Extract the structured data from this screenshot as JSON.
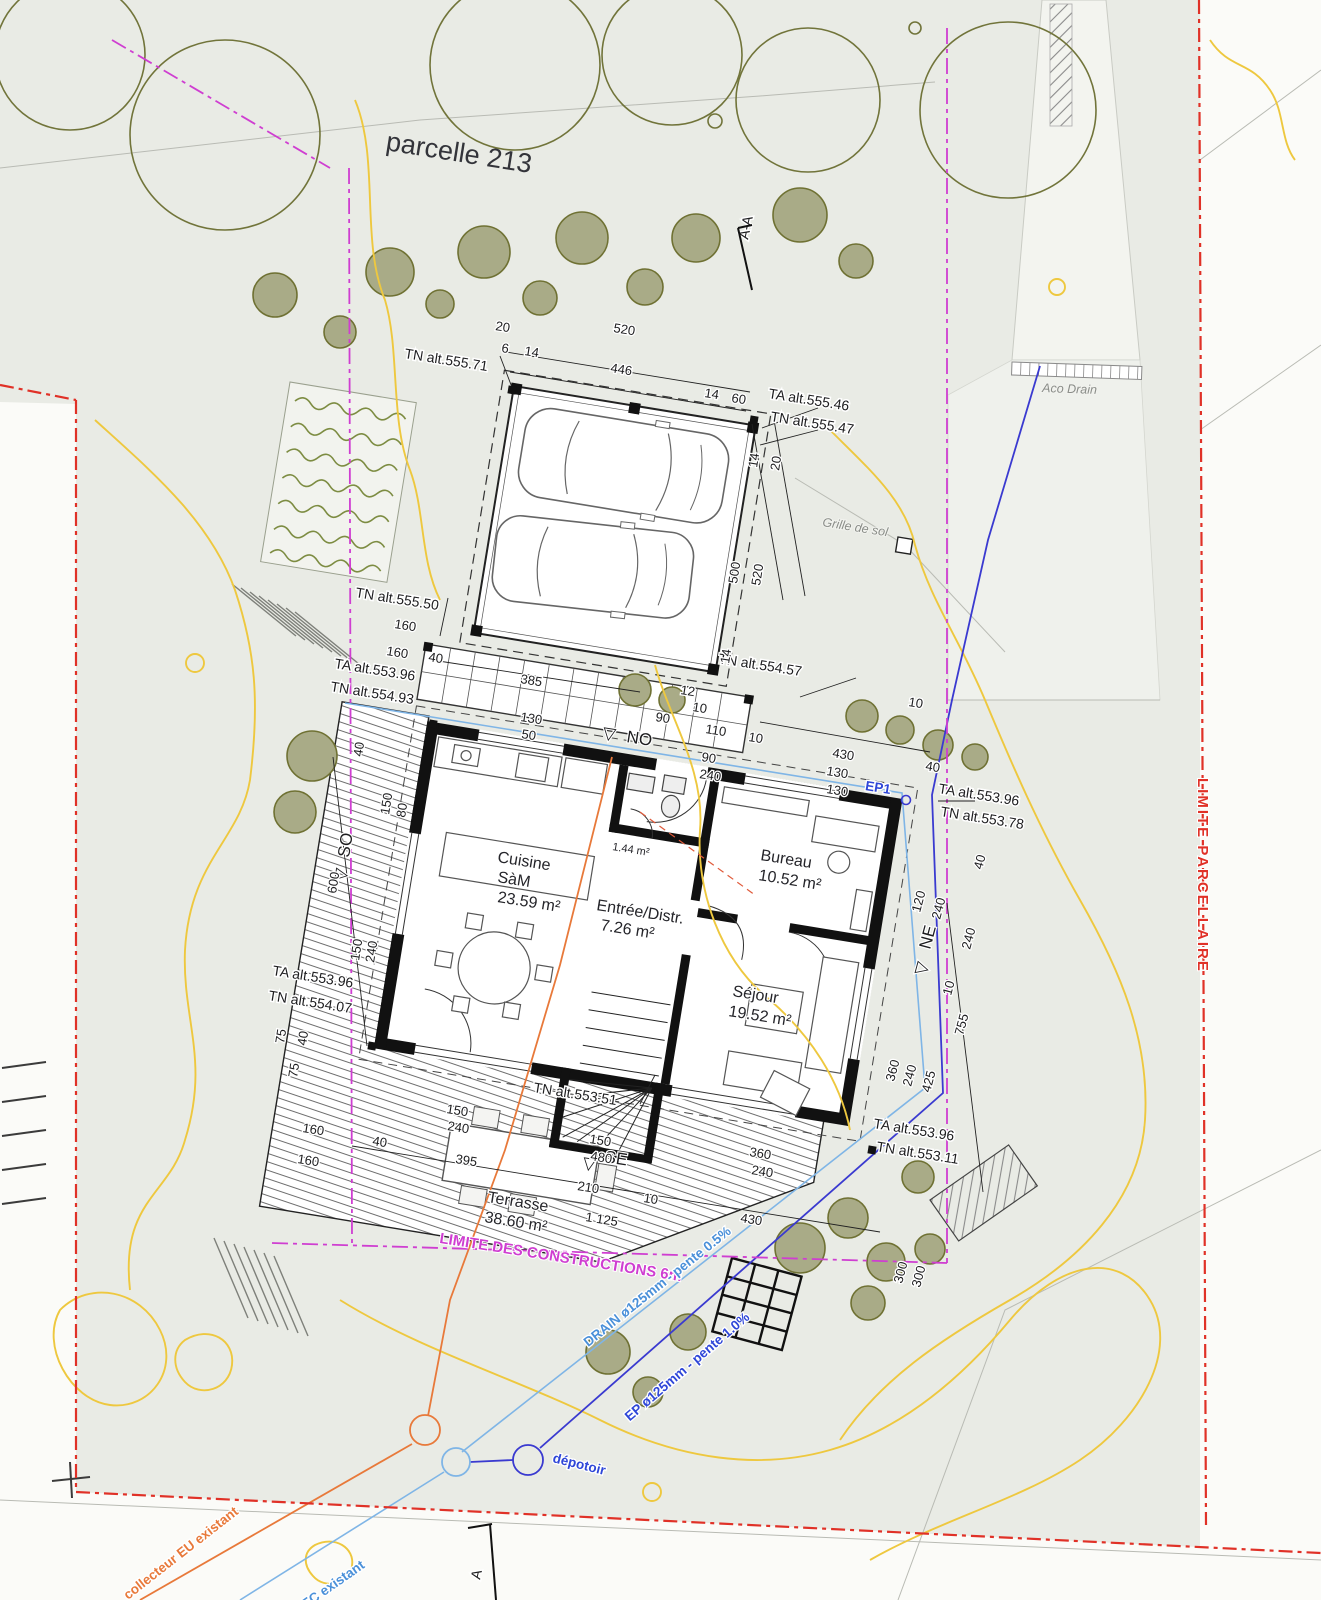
{
  "title": "parcelle 213",
  "limits": {
    "constructions": "LIMITE DES CONSTRUCTIONS 6m",
    "parcellaire": "LIMITE PARCELLAIRE"
  },
  "levels": {
    "tn_555_71": "TN alt.555.71",
    "ta_555_46": "TA alt.555.46",
    "tn_555_47": "TN alt.555.47",
    "tn_555_50": "TN alt.555.50",
    "ta_553_96_a": "TA alt.553.96",
    "tn_554_93": "TN alt.554.93",
    "tn_554_57": "TN alt.554.57",
    "ta_553_96_b": "TA alt.553.96",
    "tn_553_78": "TN alt.553.78",
    "ta_553_96_c": "TA alt.553.96",
    "tn_554_07": "TN alt.554.07",
    "tn_553_51": "TN alt.553.51",
    "ta_553_96_d": "TA alt.553.96",
    "tn_553_11": "TN alt.553.11"
  },
  "rooms": {
    "cuisine": {
      "name": "Cuisine",
      "name2": "SàM",
      "area": "23.59 m²"
    },
    "wc": {
      "area": "1.44 m²"
    },
    "entree": {
      "name": "Entrée/Distr.",
      "area": "7.26 m²"
    },
    "bureau": {
      "name": "Bureau",
      "area": "10.52 m²"
    },
    "sejour": {
      "name": "Séjour",
      "area": "19.52 m²"
    },
    "terrasse": {
      "name": "Terrasse",
      "area": "38.60 m²"
    }
  },
  "pipes": {
    "drain": "DRAIN ø125mm - pente 0.5%",
    "ep": "EP ø125mm - pente 1.0%",
    "ep1": "EP1",
    "depotoir": "dépotoir",
    "eu": "collecteur EU existant",
    "ec": "collecteur EC existant"
  },
  "site": {
    "grille": "Grille de sol",
    "aco": "Aco Drain",
    "section_aa": "A-A",
    "section_a": "A"
  },
  "compass": {
    "tri": "▽",
    "no": "NO",
    "so": "SO",
    "ne": "NE",
    "se": "SE"
  },
  "dims": [
    "20",
    "6",
    "14",
    "520",
    "446",
    "14",
    "60",
    "14",
    "20",
    "500",
    "520",
    "160",
    "160",
    "40",
    "385",
    "12",
    "10",
    "90",
    "110",
    "10",
    "90",
    "240",
    "430",
    "40",
    "14",
    "130",
    "50",
    "130",
    "130",
    "40",
    "120",
    "240",
    "240",
    "10",
    "755",
    "360",
    "240",
    "425",
    "300",
    "300",
    "40",
    "150",
    "80",
    "600",
    "150",
    "240",
    "75",
    "40",
    "75",
    "150",
    "240",
    "160",
    "40",
    "160",
    "395",
    "150",
    "480",
    "210",
    "10",
    "1 125",
    "430",
    "360",
    "240",
    "10"
  ],
  "colors": {
    "boundary_red": "#e03127",
    "construction_magenta": "#cf3ed1",
    "contour_yellow": "#eec83f",
    "pipe_drain_lightblue": "#7fb5e6",
    "pipe_ep_blue": "#3a3ad0",
    "pipe_eu_orange": "#e8793a",
    "tree_olive": "#71743a"
  }
}
